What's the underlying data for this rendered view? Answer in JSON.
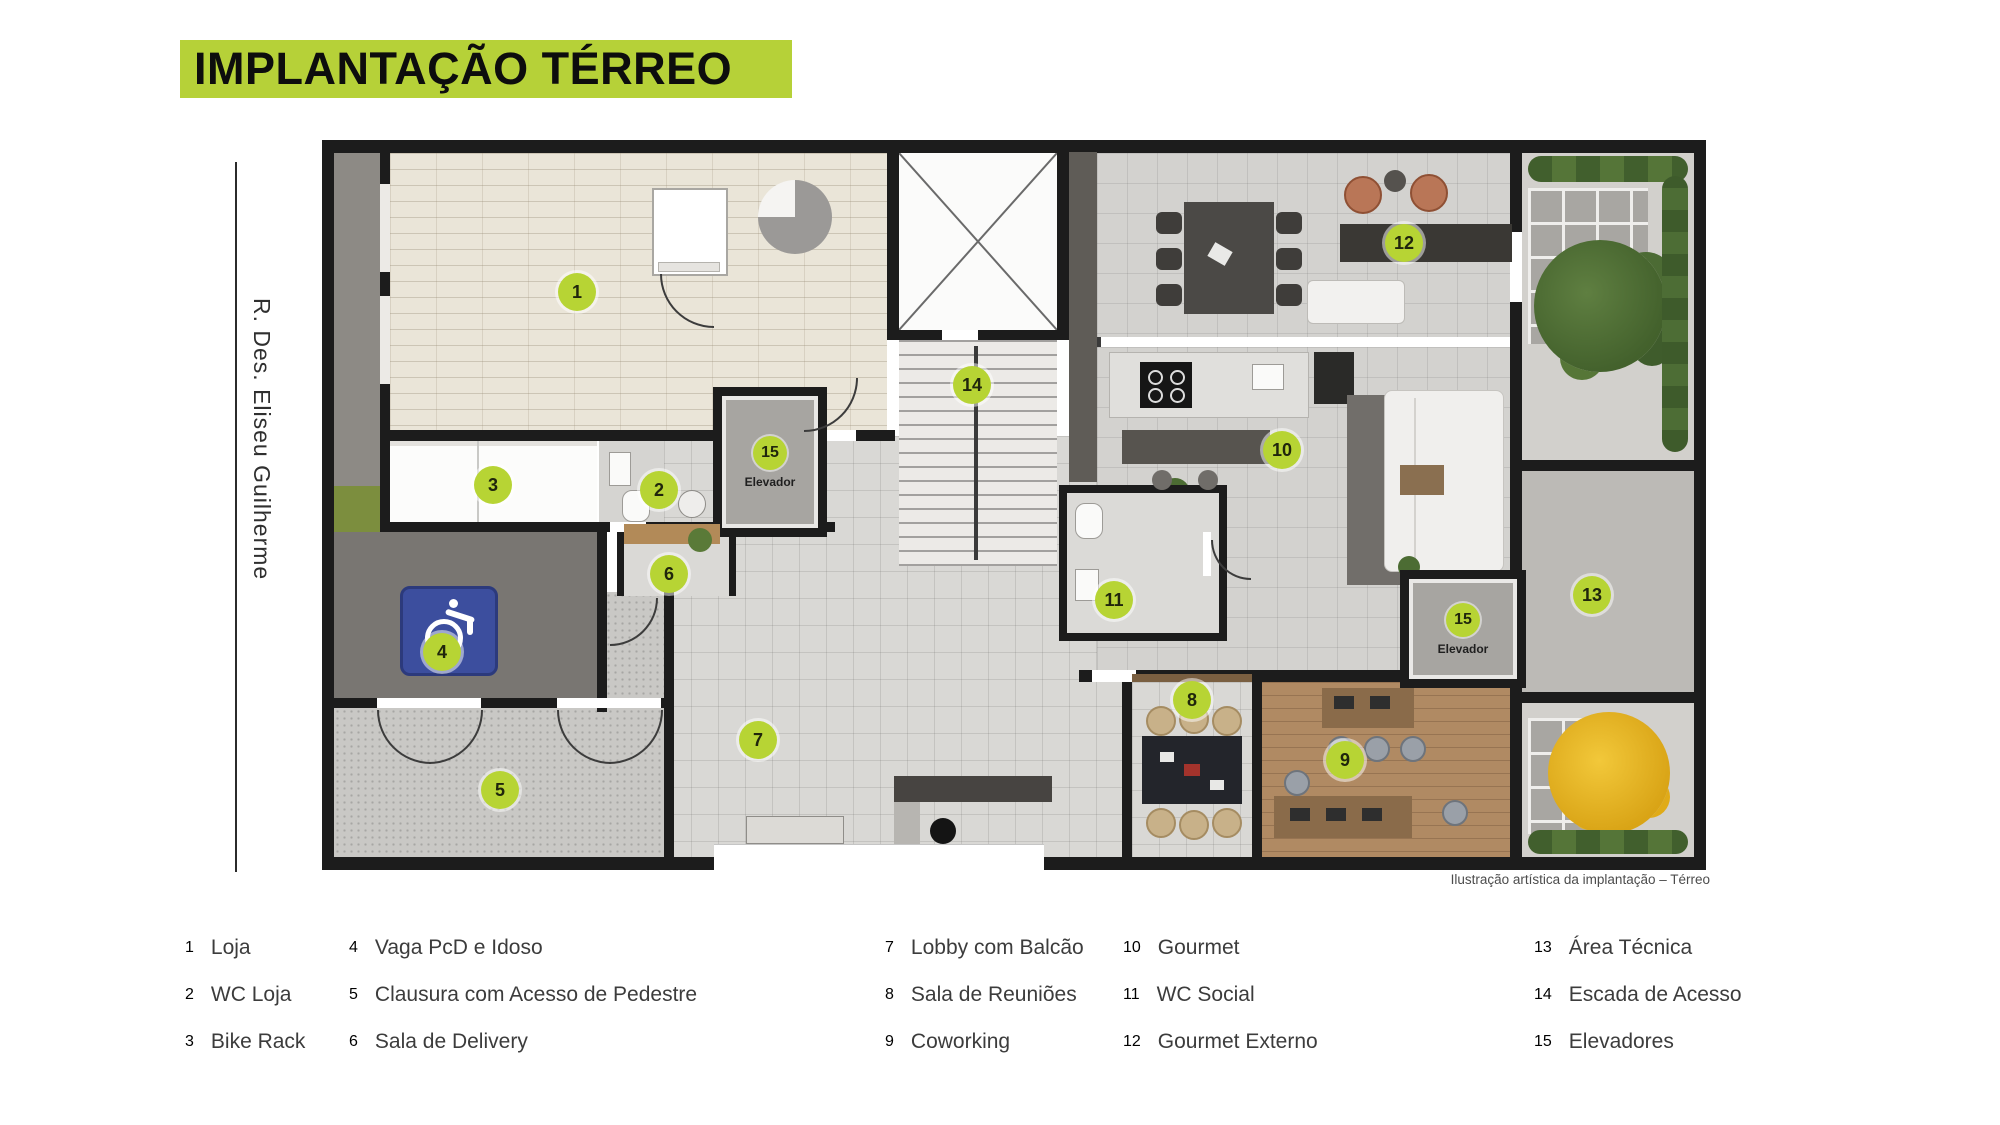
{
  "title": "IMPLANTAÇÃO TÉRREO",
  "street_label": "R. Des. Eliseu Guilherme",
  "caption": "Ilustração artística da implantação – Térreo",
  "plan": {
    "elevator_label": "Elevador",
    "markers": [
      {
        "num": "1"
      },
      {
        "num": "2"
      },
      {
        "num": "3"
      },
      {
        "num": "4"
      },
      {
        "num": "5"
      },
      {
        "num": "6"
      },
      {
        "num": "7"
      },
      {
        "num": "8"
      },
      {
        "num": "9"
      },
      {
        "num": "10"
      },
      {
        "num": "11"
      },
      {
        "num": "12"
      },
      {
        "num": "13"
      },
      {
        "num": "14"
      },
      {
        "num": "15"
      }
    ]
  },
  "legend": {
    "items": [
      {
        "num": "1",
        "label": "Loja"
      },
      {
        "num": "2",
        "label": "WC Loja"
      },
      {
        "num": "3",
        "label": "Bike Rack"
      },
      {
        "num": "4",
        "label": "Vaga PcD e Idoso"
      },
      {
        "num": "5",
        "label": "Clausura com Acesso de Pedestre"
      },
      {
        "num": "6",
        "label": "Sala de Delivery"
      },
      {
        "num": "7",
        "label": "Lobby com Balcão"
      },
      {
        "num": "8",
        "label": "Sala de Reuniões"
      },
      {
        "num": "9",
        "label": "Coworking"
      },
      {
        "num": "10",
        "label": "Gourmet"
      },
      {
        "num": "11",
        "label": "WC Social"
      },
      {
        "num": "12",
        "label": "Gourmet Externo"
      },
      {
        "num": "13",
        "label": "Área Técnica"
      },
      {
        "num": "14",
        "label": "Escada de Acesso"
      },
      {
        "num": "15",
        "label": "Elevadores"
      }
    ]
  },
  "colors": {
    "accent_green": "#b6d138",
    "marker_green": "#b7d434",
    "wall_black": "#1c1c1c",
    "pcd_sign_blue": "#3c4e9e"
  }
}
